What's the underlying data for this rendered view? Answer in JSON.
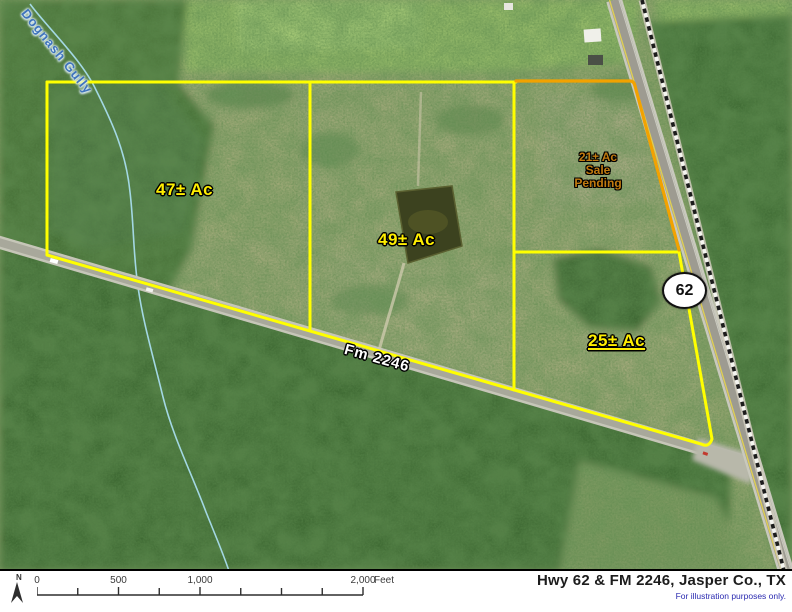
{
  "map": {
    "creek_label": "Dognash Gully",
    "parcels": {
      "p47": {
        "label": "47± Ac"
      },
      "p49": {
        "label": "49± Ac"
      },
      "p25": {
        "label": "25± Ac"
      },
      "p21": {
        "line1": "21± Ac",
        "line2": "Sale",
        "line3": "Pending"
      }
    },
    "road_label": "Fm 2246",
    "highway_shield": "62",
    "colors": {
      "boundary_yellow": "#ffff00",
      "boundary_orange_pending": "#f2a200",
      "acreage_label_yellow": "#ffee00",
      "pending_label_orange": "#c17a10",
      "creek_blue": "#a8dcec",
      "road_label_white": "#ffffff"
    }
  },
  "footer": {
    "north_label": "N",
    "scale": {
      "labels": [
        "0",
        "500",
        "1,000",
        "2,000"
      ],
      "unit": "Feet"
    },
    "title": "Hwy 62 & FM 2246, Jasper Co., TX",
    "disclaimer": "For illustration purposes only."
  }
}
